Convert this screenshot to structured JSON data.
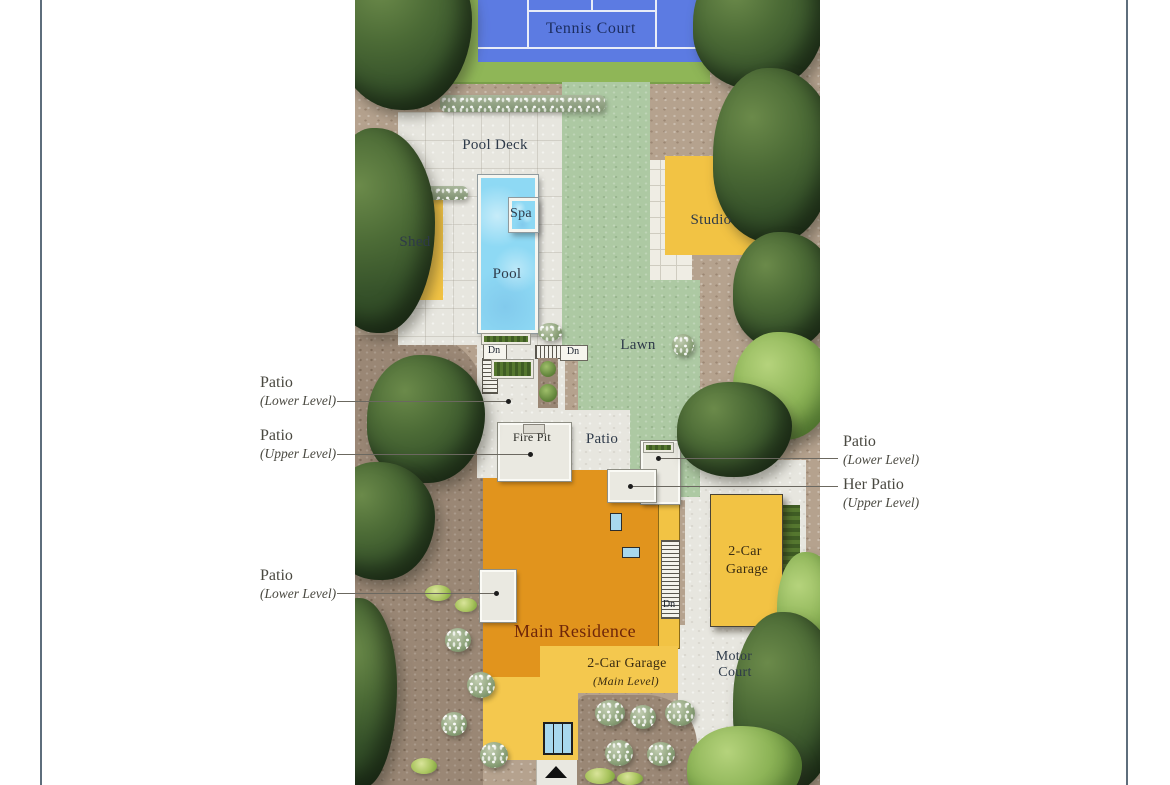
{
  "plan": {
    "labels": {
      "tennis_court": "Tennis Court",
      "pool_deck": "Pool Deck",
      "shed": "Shed",
      "spa": "Spa",
      "pool": "Pool",
      "studio": "Studio",
      "lawn": "Lawn",
      "dn": "Dn",
      "fire_pit": "Fire Pit",
      "patio_center": "Patio",
      "main_residence": "Main Residence",
      "attached_garage_line1": "2-Car Garage",
      "attached_garage_line2": "(Main Level)",
      "detached_garage_line1": "2-Car",
      "detached_garage_line2": "Garage",
      "motor_court_line1": "Motor",
      "motor_court_line2": "Court"
    },
    "colors": {
      "court_blue": "#5c7be2",
      "court_line_white": "#e9edf8",
      "court_surround_green": "#8fb657",
      "lawn_green": "#adc9a3",
      "pool_water_blue": "#8ed9f4",
      "paving_gray": "#e7e6df",
      "gravel_tan": "#b5a28e",
      "mulch_brown": "#9a8775",
      "building_yellow": "#f2c344",
      "residence_orange": "#e1941d",
      "tree_dark_green": "#36522a",
      "tree_light_green": "#8db457",
      "label_navy": "#1c2d5f",
      "label_dark": "#2e3a49",
      "residence_label_maroon": "#6e2609",
      "annotation_text": "#494840"
    }
  },
  "annotations": {
    "left": [
      {
        "title": "Patio",
        "subtitle": "(Lower Level)"
      },
      {
        "title": "Patio",
        "subtitle": "(Upper Level)"
      },
      {
        "title": "Patio",
        "subtitle": "(Lower Level)"
      }
    ],
    "right": [
      {
        "title": "Patio",
        "subtitle": "(Lower Level)"
      },
      {
        "title": "Her Patio",
        "subtitle": "(Upper Level)"
      }
    ]
  }
}
